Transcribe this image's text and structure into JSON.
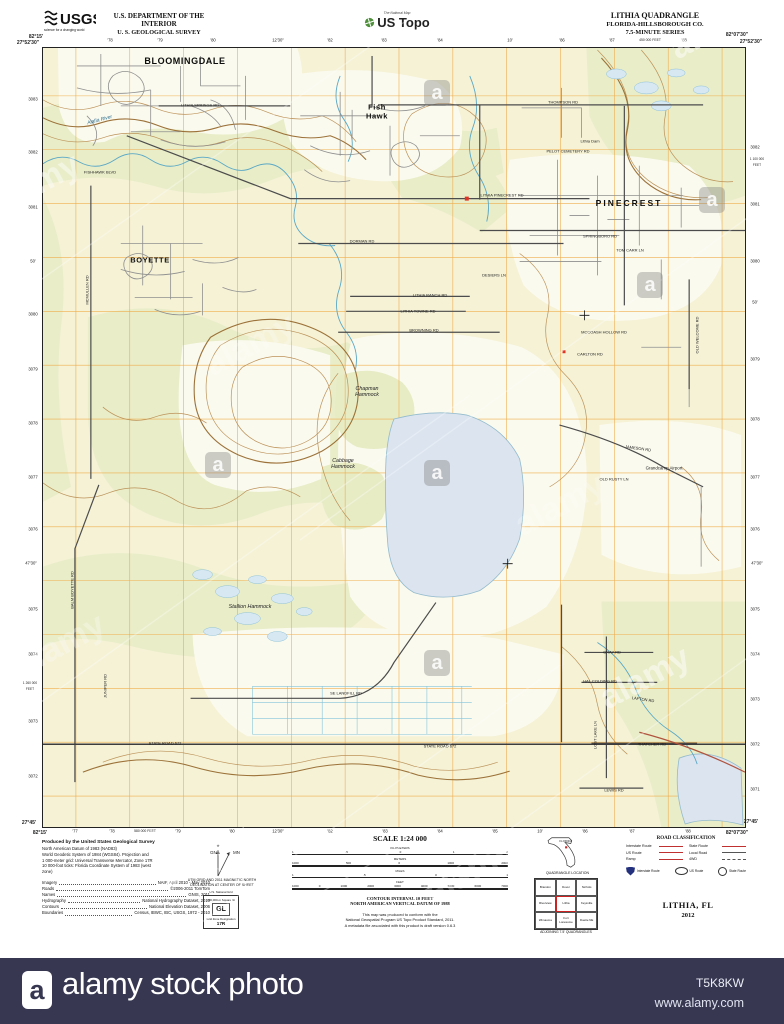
{
  "header": {
    "agency": "USGS",
    "agency_tagline": "science for a changing world",
    "dept_line1": "U.S. DEPARTMENT OF THE INTERIOR",
    "dept_line2": "U. S. GEOLOGICAL SURVEY",
    "ustopo_tag": "The National Map",
    "ustopo_brand": "US Topo",
    "quad_title": "LITHIA QUADRANGLE",
    "quad_subtitle": "FLORIDA-HILLSBOROUGH CO.",
    "quad_series": "7.5-MINUTE SERIES"
  },
  "map": {
    "colors": {
      "background": "#f5f2d6",
      "woodland": "#e9edc8",
      "open": "#fbfaee",
      "grid": "#efa63e",
      "contour": "#b98d52",
      "index_contour": "#976a2f",
      "water_line": "#5aa8c6",
      "water_fill": "#dbe4ef",
      "road_major": "#4c4c4c",
      "road_minor": "#8f8f8f",
      "route_red": "#b0533d",
      "building_red": "#e03425"
    },
    "labels": [
      {
        "t": "82°15'",
        "x": 36,
        "y": 38,
        "cls": "corner"
      },
      {
        "t": "27°52'30\"",
        "x": 28,
        "y": 44,
        "cls": "corner"
      },
      {
        "t": "82°07'30\"",
        "x": 737,
        "y": 36,
        "cls": "corner"
      },
      {
        "t": "27°52'30\"",
        "x": 751,
        "y": 43,
        "cls": "corner"
      },
      {
        "t": "82°15'",
        "x": 40,
        "y": 834,
        "cls": "corner"
      },
      {
        "t": "27°45'",
        "x": 29,
        "y": 824,
        "cls": "corner"
      },
      {
        "t": "82°07'30\"",
        "x": 737,
        "y": 834,
        "cls": "corner"
      },
      {
        "t": "27°45'",
        "x": 751,
        "y": 823,
        "cls": "corner"
      },
      {
        "t": "'78",
        "x": 110,
        "y": 41,
        "cls": "tick"
      },
      {
        "t": "'79",
        "x": 160,
        "y": 41,
        "cls": "tick"
      },
      {
        "t": "'80",
        "x": 213,
        "y": 41,
        "cls": "tick"
      },
      {
        "t": "12'30\"",
        "x": 278,
        "y": 41,
        "cls": "tick"
      },
      {
        "t": "'82",
        "x": 330,
        "y": 41,
        "cls": "tick"
      },
      {
        "t": "'83",
        "x": 384,
        "y": 41,
        "cls": "tick"
      },
      {
        "t": "'84",
        "x": 440,
        "y": 41,
        "cls": "tick"
      },
      {
        "t": "10'",
        "x": 510,
        "y": 41,
        "cls": "tick"
      },
      {
        "t": "'86",
        "x": 562,
        "y": 41,
        "cls": "tick"
      },
      {
        "t": "'87",
        "x": 612,
        "y": 41,
        "cls": "tick"
      },
      {
        "t": "450 000 FEET",
        "x": 650,
        "y": 41,
        "cls": "tick",
        "size": 3.4
      },
      {
        "t": "'88",
        "x": 684,
        "y": 41,
        "cls": "tick"
      },
      {
        "t": "'77",
        "x": 75,
        "y": 832,
        "cls": "tick"
      },
      {
        "t": "'78",
        "x": 112,
        "y": 832,
        "cls": "tick"
      },
      {
        "t": "580 000 FEET",
        "x": 145,
        "y": 832,
        "cls": "tick",
        "size": 3.4
      },
      {
        "t": "'79",
        "x": 178,
        "y": 832,
        "cls": "tick"
      },
      {
        "t": "'80",
        "x": 232,
        "y": 832,
        "cls": "tick"
      },
      {
        "t": "12'30\"",
        "x": 278,
        "y": 832,
        "cls": "tick"
      },
      {
        "t": "'82",
        "x": 330,
        "y": 832,
        "cls": "tick"
      },
      {
        "t": "'83",
        "x": 385,
        "y": 832,
        "cls": "tick"
      },
      {
        "t": "'84",
        "x": 440,
        "y": 832,
        "cls": "tick"
      },
      {
        "t": "'85",
        "x": 495,
        "y": 832,
        "cls": "tick"
      },
      {
        "t": "10'",
        "x": 540,
        "y": 832,
        "cls": "tick"
      },
      {
        "t": "'86",
        "x": 585,
        "y": 832,
        "cls": "tick"
      },
      {
        "t": "'87",
        "x": 632,
        "y": 832,
        "cls": "tick"
      },
      {
        "t": "'88",
        "x": 688,
        "y": 832,
        "cls": "tick"
      },
      {
        "t": "3083",
        "x": 33,
        "y": 100,
        "cls": "tick"
      },
      {
        "t": "3082",
        "x": 33,
        "y": 153,
        "cls": "tick"
      },
      {
        "t": "3081",
        "x": 33,
        "y": 208,
        "cls": "tick"
      },
      {
        "t": "50'",
        "x": 33,
        "y": 262,
        "cls": "tick"
      },
      {
        "t": "3080",
        "x": 33,
        "y": 315,
        "cls": "tick"
      },
      {
        "t": "3079",
        "x": 33,
        "y": 370,
        "cls": "tick"
      },
      {
        "t": "3078",
        "x": 33,
        "y": 424,
        "cls": "tick"
      },
      {
        "t": "3077",
        "x": 33,
        "y": 478,
        "cls": "tick"
      },
      {
        "t": "3076",
        "x": 33,
        "y": 530,
        "cls": "tick"
      },
      {
        "t": "47'30\"",
        "x": 31,
        "y": 564,
        "cls": "tick"
      },
      {
        "t": "3075",
        "x": 33,
        "y": 610,
        "cls": "tick"
      },
      {
        "t": "3074",
        "x": 33,
        "y": 655,
        "cls": "tick"
      },
      {
        "t": "1 260 000",
        "x": 30,
        "y": 684,
        "cls": "tick",
        "size": 3.2
      },
      {
        "t": "FEET",
        "x": 30,
        "y": 690,
        "cls": "tick",
        "size": 3.2
      },
      {
        "t": "3073",
        "x": 33,
        "y": 722,
        "cls": "tick"
      },
      {
        "t": "3072",
        "x": 33,
        "y": 777,
        "cls": "tick"
      },
      {
        "t": "3082",
        "x": 755,
        "y": 148,
        "cls": "tick"
      },
      {
        "t": "1 100 000",
        "x": 757,
        "y": 160,
        "cls": "tick",
        "size": 3.2
      },
      {
        "t": "FEET",
        "x": 757,
        "y": 166,
        "cls": "tick",
        "size": 3.2
      },
      {
        "t": "3081",
        "x": 755,
        "y": 205,
        "cls": "tick"
      },
      {
        "t": "3080",
        "x": 755,
        "y": 262,
        "cls": "tick"
      },
      {
        "t": "50'",
        "x": 755,
        "y": 303,
        "cls": "tick"
      },
      {
        "t": "3079",
        "x": 755,
        "y": 360,
        "cls": "tick"
      },
      {
        "t": "3078",
        "x": 755,
        "y": 420,
        "cls": "tick"
      },
      {
        "t": "3077",
        "x": 755,
        "y": 478,
        "cls": "tick"
      },
      {
        "t": "3076",
        "x": 755,
        "y": 530,
        "cls": "tick"
      },
      {
        "t": "47'30\"",
        "x": 757,
        "y": 564,
        "cls": "tick"
      },
      {
        "t": "3075",
        "x": 755,
        "y": 610,
        "cls": "tick"
      },
      {
        "t": "3074",
        "x": 755,
        "y": 655,
        "cls": "tick"
      },
      {
        "t": "3073",
        "x": 755,
        "y": 700,
        "cls": "tick"
      },
      {
        "t": "3072",
        "x": 755,
        "y": 745,
        "cls": "tick"
      },
      {
        "t": "3071",
        "x": 755,
        "y": 790,
        "cls": "tick"
      },
      {
        "t": "BLOOMINGDALE",
        "x": 185,
        "y": 61,
        "cls": "town",
        "size": 9
      },
      {
        "t": "Fish\nHawk",
        "x": 377,
        "y": 112,
        "cls": "town",
        "size": 7.5
      },
      {
        "t": "BOYETTE",
        "x": 150,
        "y": 261,
        "cls": "town",
        "size": 7.5
      },
      {
        "t": "PINECREST",
        "x": 629,
        "y": 204,
        "cls": "town",
        "size": 8.5,
        "ls": 2
      },
      {
        "t": "Chapman\nHammock",
        "x": 367,
        "y": 392,
        "cls": "ham"
      },
      {
        "t": "Cabbage\nHammock",
        "x": 343,
        "y": 464,
        "cls": "ham"
      },
      {
        "t": "Stallion Hammock",
        "x": 250,
        "y": 607,
        "cls": "ham"
      },
      {
        "t": "Grandcamp Airport",
        "x": 664,
        "y": 468,
        "cls": "road",
        "size": 4.4
      },
      {
        "t": "Alafia River",
        "x": 100,
        "y": 121,
        "cls": "water",
        "rot": -15
      },
      {
        "t": "LITHIA SPRINGS RD",
        "x": 200,
        "y": 106,
        "cls": "road"
      },
      {
        "t": "FISHHAWK BLVD",
        "x": 100,
        "y": 173,
        "cls": "road"
      },
      {
        "t": "THOMPSON RD",
        "x": 563,
        "y": 103,
        "cls": "road"
      },
      {
        "t": "PELOT CEMETERY RD",
        "x": 568,
        "y": 152,
        "cls": "road"
      },
      {
        "t": "Lithia Dam",
        "x": 590,
        "y": 142,
        "cls": "road"
      },
      {
        "t": "LITHIA PINECREST RD",
        "x": 502,
        "y": 196,
        "cls": "road"
      },
      {
        "t": "DORMAN RD",
        "x": 362,
        "y": 242,
        "cls": "road"
      },
      {
        "t": "DESIERS LN",
        "x": 494,
        "y": 276,
        "cls": "road"
      },
      {
        "t": "LITHIA RANCH RD",
        "x": 430,
        "y": 296,
        "cls": "road"
      },
      {
        "t": "LITHIA TOWNE RD",
        "x": 418,
        "y": 312,
        "cls": "road"
      },
      {
        "t": "BROWNING RD",
        "x": 424,
        "y": 331,
        "cls": "road"
      },
      {
        "t": "MCCOASH HOLLOW RD",
        "x": 604,
        "y": 333,
        "cls": "road"
      },
      {
        "t": "CARLTON RD",
        "x": 590,
        "y": 355,
        "cls": "road"
      },
      {
        "t": "OLD WELCOME RD",
        "x": 698,
        "y": 335,
        "cls": "road",
        "rot": -90
      },
      {
        "t": "SPRINGBORO RD",
        "x": 600,
        "y": 237,
        "cls": "road"
      },
      {
        "t": "TOM CARR LN",
        "x": 630,
        "y": 251,
        "cls": "road"
      },
      {
        "t": "JAMESON RD",
        "x": 638,
        "y": 449,
        "cls": "road",
        "rot": 8
      },
      {
        "t": "OLD RUSTY LN",
        "x": 614,
        "y": 480,
        "cls": "road"
      },
      {
        "t": "BALM BOYETTE RD",
        "x": 73,
        "y": 590,
        "cls": "road",
        "rot": -90
      },
      {
        "t": "MCMULLEN RD",
        "x": 88,
        "y": 290,
        "cls": "road",
        "rot": -90
      },
      {
        "t": "JUNIPER RD",
        "x": 106,
        "y": 686,
        "cls": "road",
        "rot": -90
      },
      {
        "t": "SE LANDFILL RD",
        "x": 346,
        "y": 694,
        "cls": "road"
      },
      {
        "t": "STATE ROAD 672",
        "x": 165,
        "y": 744,
        "cls": "road"
      },
      {
        "t": "STATE ROAD 672",
        "x": 440,
        "y": 747,
        "cls": "road"
      },
      {
        "t": "GRAY RD",
        "x": 612,
        "y": 653,
        "cls": "road"
      },
      {
        "t": "HAL COLDING RD",
        "x": 600,
        "y": 682,
        "cls": "road"
      },
      {
        "t": "LAFTON RD",
        "x": 643,
        "y": 700,
        "cls": "road",
        "rot": 8
      },
      {
        "t": "THATCHER RD",
        "x": 652,
        "y": 745,
        "cls": "road"
      },
      {
        "t": "LOST LAKE LN",
        "x": 596,
        "y": 735,
        "cls": "road",
        "rot": -90
      },
      {
        "t": "LEWIS RD",
        "x": 614,
        "y": 791,
        "cls": "road"
      }
    ]
  },
  "footer": {
    "produced": [
      "Produced by the United States Geological Survey",
      "North American Datum of 1983 (NAD83)",
      "World Geodetic System of 1984 (WGS84). Projection and",
      "1 000-meter grid: Universal Transverse Mercator, Zone 17R",
      "10 000-foot ticks: Florida Coordinate System of 1983 (west",
      "zone)"
    ],
    "credits": [
      {
        "label": "Imagery",
        "value": "NAIP, April 2010 - May 2010"
      },
      {
        "label": "Roads",
        "value": "©2006-2011 TomTom"
      },
      {
        "label": "Names",
        "value": "GNIS, 2011"
      },
      {
        "label": "Hydrography",
        "value": "National Hydrography Dataset, 2010"
      },
      {
        "label": "Contours",
        "value": "National Elevation Dataset, 2006"
      },
      {
        "label": "Boundaries",
        "value": "Census, IBWC, IBC, USGS, 1972 - 2010"
      }
    ],
    "declination": {
      "line1": "UTM GRID AND 2011 MAGNETIC NORTH",
      "line2": "DECLINATION AT CENTER OF SHEET",
      "gn": "GN",
      "mn": "MN"
    },
    "usng": {
      "title": "U.S. National Grid",
      "sub": "100,000-m Square ID",
      "square": "GL",
      "zone_label": "Grid Zone Designation",
      "zone": "17R"
    },
    "scale": {
      "title": "SCALE 1:24 000",
      "bars": [
        {
          "unit": "KILOMETERS",
          "nums": [
            "1",
            ".5",
            "0",
            "1",
            "2"
          ]
        },
        {
          "unit": "METERS",
          "nums": [
            "1000",
            "500",
            "0",
            "1000",
            "2000"
          ]
        },
        {
          "unit": "MILES",
          "nums": [
            "1",
            ".5",
            "0",
            "1"
          ]
        },
        {
          "unit": "FEET",
          "nums": [
            "1000",
            "0",
            "1000",
            "2000",
            "3000",
            "4000",
            "5000",
            "6000",
            "7000"
          ]
        }
      ]
    },
    "contour_note1": "CONTOUR INTERVAL 10 FEET",
    "contour_note2": "NORTH AMERICAN VERTICAL DATUM OF 1988",
    "product_note": [
      "This map was produced to conform with the",
      "National Geospatial Program US Topo Product Standard, 2011.",
      "A metadata file associated with this product is draft version 0.6.3"
    ],
    "quadloc": {
      "state": "FLORIDA",
      "caption": "QUADRANGLE LOCATION"
    },
    "adjoining": {
      "names": [
        "Brandon",
        "Dover",
        "Nichols",
        "Riverview",
        "Lithia",
        "Keysville",
        "Wimauma",
        "Fort Lonesome",
        "Duette NE"
      ],
      "caption": "ADJOINING 7.5' QUADRANGLES"
    },
    "roadclass": {
      "title": "ROAD CLASSIFICATION",
      "left": [
        "Interstate Route",
        "US Route",
        "Ramp"
      ],
      "right": [
        "State Route",
        "Local Road",
        "4WD"
      ],
      "shields": [
        "Interstate Route",
        "US Route",
        "State Route"
      ]
    },
    "mapname": "LITHIA, FL",
    "year": "2012"
  },
  "watermark": {
    "brand": "alamy",
    "bar": {
      "logo": "a",
      "label": "alamy stock photo",
      "id": "T5K8KW",
      "url": "www.alamy.com"
    },
    "marks": [
      {
        "k": "t",
        "x": 715,
        "y": 28,
        "o": 0.5
      },
      {
        "k": "t",
        "x": 35,
        "y": 185,
        "o": 0.45
      },
      {
        "k": "t",
        "x": 250,
        "y": 345,
        "o": 0.22
      },
      {
        "k": "t",
        "x": 560,
        "y": 505,
        "o": 0.22
      },
      {
        "k": "t",
        "x": 645,
        "y": 678,
        "o": 0.5
      },
      {
        "k": "t",
        "x": 60,
        "y": 645,
        "o": 0.28
      },
      {
        "k": "t",
        "x": 205,
        "y": 856,
        "o": 0.38
      },
      {
        "k": "t",
        "x": 470,
        "y": 872,
        "o": 0.25
      },
      {
        "k": "a",
        "x": 437,
        "y": 93
      },
      {
        "k": "a",
        "x": 650,
        "y": 285
      },
      {
        "k": "a",
        "x": 218,
        "y": 465
      },
      {
        "k": "a",
        "x": 437,
        "y": 473
      },
      {
        "k": "a",
        "x": 437,
        "y": 663
      },
      {
        "k": "a",
        "x": 712,
        "y": 200
      }
    ]
  }
}
